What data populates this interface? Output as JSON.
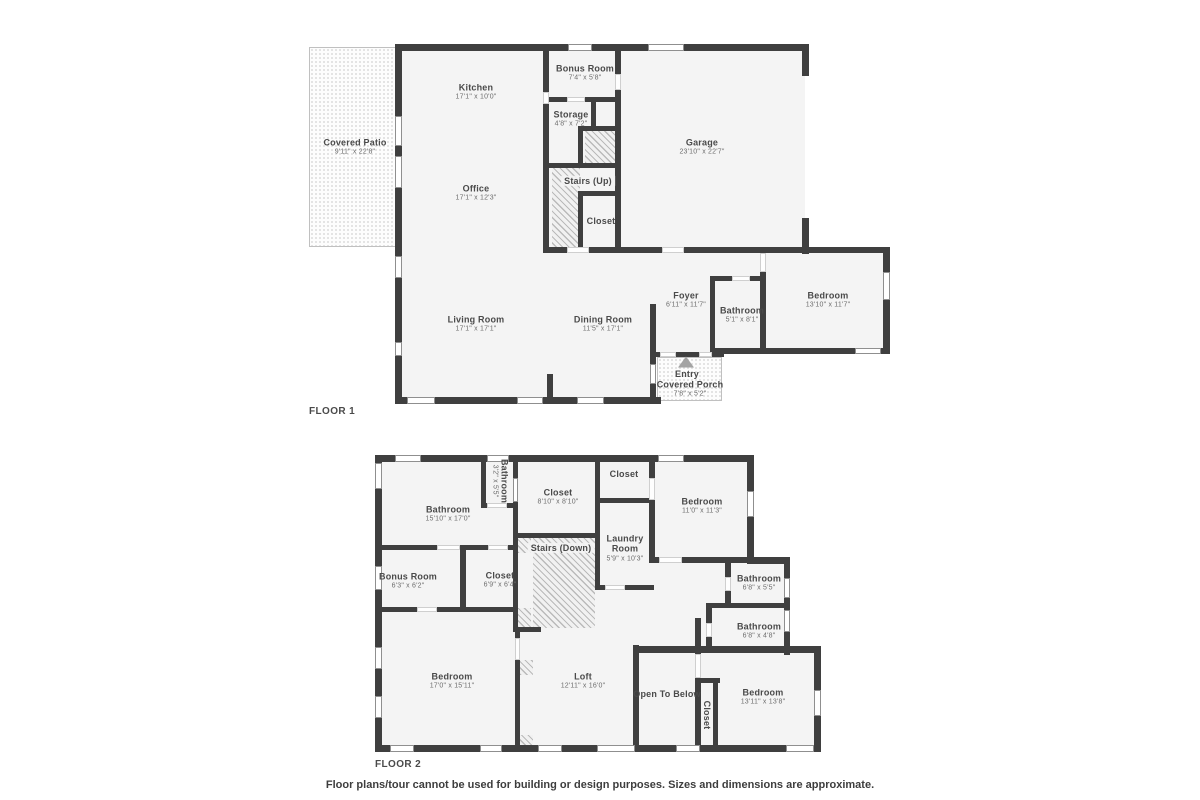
{
  "footer": "Floor plans/tour cannot be used for building or design purposes. Sizes and dimensions are approximate.",
  "colors": {
    "wall": "#3f3f3f",
    "room_fill": "#f4f4f4",
    "label_text": "#4a4a4a",
    "dims_text": "#6d6d6d",
    "outdoor_border": "#c0c0c0"
  },
  "floors": [
    {
      "label": "FLOOR 1",
      "fills": [
        [
          398,
          47,
          407,
          203
        ],
        [
          398,
          250,
          258,
          150
        ],
        [
          656,
          250,
          230,
          104
        ]
      ],
      "outdoor": [
        [
          309,
          47,
          90,
          200
        ],
        [
          657,
          357,
          65,
          44
        ]
      ],
      "hatch": [
        [
          585,
          130,
          30,
          33
        ],
        [
          552,
          168,
          28,
          82
        ]
      ],
      "walls": [
        [
          395,
          44,
          414,
          7
        ],
        [
          395,
          44,
          7,
          360
        ],
        [
          395,
          397,
          266,
          7
        ],
        [
          802,
          44,
          7,
          32
        ],
        [
          802,
          218,
          7,
          36
        ],
        [
          543,
          247,
          24,
          6
        ],
        [
          589,
          247,
          73,
          6
        ],
        [
          684,
          247,
          205,
          6
        ],
        [
          543,
          44,
          6,
          48
        ],
        [
          543,
          104,
          6,
          149
        ],
        [
          615,
          44,
          6,
          30
        ],
        [
          615,
          90,
          6,
          163
        ],
        [
          543,
          97,
          24,
          5
        ],
        [
          585,
          97,
          36,
          5
        ],
        [
          591,
          102,
          5,
          28
        ],
        [
          578,
          126,
          43,
          5
        ],
        [
          578,
          126,
          5,
          42
        ],
        [
          543,
          163,
          78,
          5
        ],
        [
          578,
          191,
          43,
          5
        ],
        [
          578,
          191,
          5,
          62
        ],
        [
          547,
          374,
          6,
          30
        ],
        [
          650,
          304,
          6,
          100
        ],
        [
          650,
          352,
          10,
          5
        ],
        [
          676,
          352,
          23,
          5
        ],
        [
          712,
          352,
          12,
          5
        ],
        [
          710,
          276,
          5,
          78
        ],
        [
          710,
          276,
          22,
          5
        ],
        [
          750,
          276,
          15,
          5
        ],
        [
          760,
          272,
          6,
          82
        ],
        [
          710,
          348,
          180,
          6
        ],
        [
          883,
          247,
          7,
          107
        ]
      ],
      "windows": [
        [
          568,
          44,
          24,
          7
        ],
        [
          648,
          44,
          36,
          7
        ],
        [
          395,
          116,
          7,
          30
        ],
        [
          395,
          156,
          7,
          32
        ],
        [
          395,
          256,
          7,
          22
        ],
        [
          395,
          342,
          7,
          14
        ],
        [
          407,
          397,
          28,
          7
        ],
        [
          517,
          397,
          26,
          7
        ],
        [
          577,
          397,
          27,
          7
        ],
        [
          650,
          364,
          6,
          20
        ],
        [
          883,
          272,
          7,
          28
        ],
        [
          855,
          348,
          26,
          6
        ]
      ],
      "doors": [
        [
          567,
          247,
          22,
          6
        ],
        [
          662,
          247,
          22,
          6
        ],
        [
          567,
          97,
          18,
          5
        ],
        [
          543,
          92,
          6,
          12
        ],
        [
          615,
          74,
          6,
          16
        ],
        [
          732,
          276,
          18,
          5
        ],
        [
          760,
          253,
          6,
          19
        ],
        [
          660,
          352,
          16,
          5
        ],
        [
          699,
          352,
          13,
          5
        ]
      ],
      "rooms": [
        {
          "name": "Covered Patio",
          "dims": "9'11\" x 22'8\"",
          "pos": [
            355,
            147
          ]
        },
        {
          "name": "Kitchen",
          "dims": "17'1\" x 10'0\"",
          "pos": [
            476,
            92
          ]
        },
        {
          "name": "Bonus Room",
          "dims": "7'4\" x 5'8\"",
          "pos": [
            585,
            73
          ]
        },
        {
          "name": "Storage",
          "dims": "4'8\" x 7'2\"",
          "pos": [
            571,
            119
          ]
        },
        {
          "name": "Office",
          "dims": "17'1\" x 12'3\"",
          "pos": [
            476,
            193
          ]
        },
        {
          "name": "Stairs (Up)",
          "dims": "",
          "pos": [
            588,
            181
          ],
          "bg": true
        },
        {
          "name": "Closet",
          "dims": "",
          "pos": [
            601,
            221
          ]
        },
        {
          "name": "Garage",
          "dims": "23'10\" x 22'7\"",
          "pos": [
            702,
            147
          ]
        },
        {
          "name": "Living Room",
          "dims": "17'1\" x 17'1\"",
          "pos": [
            476,
            324
          ]
        },
        {
          "name": "Dining Room",
          "dims": "11'5\" x 17'1\"",
          "pos": [
            603,
            324
          ]
        },
        {
          "name": "Foyer",
          "dims": "6'11\" x 11'7\"",
          "pos": [
            686,
            300
          ]
        },
        {
          "name": "Bathroom",
          "dims": "5'1\" x 8'1\"",
          "pos": [
            742,
            315
          ]
        },
        {
          "name": "Bedroom",
          "dims": "13'10\" x 11'7\"",
          "pos": [
            828,
            300
          ]
        },
        {
          "name": "Entry",
          "dims": "",
          "pos": [
            687,
            374
          ]
        },
        {
          "name": "Covered Porch",
          "dims": "7'8\" x 5'2\"",
          "pos": [
            690,
            389
          ]
        }
      ],
      "entry_icon": [
        686,
        362
      ]
    },
    {
      "label": "FLOOR 2",
      "fills": [
        [
          379,
          459,
          372,
          290
        ],
        [
          751,
          560,
          36,
          188
        ],
        [
          787,
          652,
          31,
          96
        ]
      ],
      "outdoor": [],
      "hatch": [
        [
          518,
          538,
          13,
          15
        ],
        [
          533,
          538,
          62,
          90
        ],
        [
          518,
          608,
          13,
          20
        ],
        [
          520,
          660,
          13,
          15
        ],
        [
          520,
          735,
          13,
          12
        ]
      ],
      "walls": [
        [
          375,
          455,
          379,
          7
        ],
        [
          375,
          455,
          7,
          297
        ],
        [
          375,
          745,
          446,
          7
        ],
        [
          747,
          455,
          7,
          109
        ],
        [
          747,
          557,
          43,
          7
        ],
        [
          784,
          557,
          6,
          98
        ],
        [
          784,
          646,
          37,
          7
        ],
        [
          814,
          649,
          7,
          103
        ],
        [
          481,
          455,
          5,
          53
        ],
        [
          513,
          455,
          5,
          83
        ],
        [
          595,
          455,
          5,
          135
        ],
        [
          649,
          455,
          6,
          23
        ],
        [
          649,
          500,
          6,
          63
        ],
        [
          460,
          545,
          6,
          67
        ],
        [
          513,
          533,
          5,
          99
        ],
        [
          515,
          628,
          5,
          10
        ],
        [
          515,
          660,
          5,
          90
        ],
        [
          633,
          645,
          6,
          105
        ],
        [
          695,
          618,
          6,
          36
        ],
        [
          695,
          678,
          6,
          72
        ],
        [
          713,
          678,
          5,
          72
        ],
        [
          695,
          678,
          25,
          5
        ],
        [
          725,
          563,
          6,
          14
        ],
        [
          725,
          591,
          6,
          16
        ],
        [
          706,
          607,
          6,
          16
        ],
        [
          706,
          637,
          6,
          14
        ],
        [
          481,
          503,
          37,
          5
        ],
        [
          513,
          533,
          87,
          5
        ],
        [
          595,
          498,
          59,
          5
        ],
        [
          649,
          557,
          10,
          6
        ],
        [
          682,
          557,
          108,
          6
        ],
        [
          375,
          545,
          62,
          5
        ],
        [
          466,
          545,
          24,
          5
        ],
        [
          508,
          545,
          10,
          5
        ],
        [
          375,
          607,
          42,
          5
        ],
        [
          437,
          607,
          81,
          5
        ],
        [
          595,
          585,
          10,
          5
        ],
        [
          625,
          585,
          29,
          5
        ],
        [
          513,
          627,
          28,
          5
        ],
        [
          633,
          646,
          188,
          7
        ],
        [
          706,
          603,
          84,
          5
        ]
      ],
      "windows": [
        [
          395,
          455,
          26,
          7
        ],
        [
          487,
          455,
          22,
          7
        ],
        [
          658,
          455,
          26,
          7
        ],
        [
          375,
          463,
          7,
          26
        ],
        [
          375,
          566,
          7,
          24
        ],
        [
          375,
          647,
          7,
          22
        ],
        [
          375,
          696,
          7,
          22
        ],
        [
          390,
          745,
          24,
          7
        ],
        [
          480,
          745,
          22,
          7
        ],
        [
          538,
          745,
          24,
          7
        ],
        [
          597,
          745,
          38,
          7
        ],
        [
          676,
          745,
          24,
          7
        ],
        [
          786,
          745,
          28,
          7
        ],
        [
          747,
          491,
          7,
          26
        ],
        [
          784,
          578,
          6,
          20
        ],
        [
          784,
          610,
          6,
          22
        ],
        [
          814,
          690,
          7,
          26
        ],
        [
          513,
          478,
          5,
          24
        ]
      ],
      "doors": [
        [
          487,
          503,
          20,
          5
        ],
        [
          437,
          545,
          23,
          5
        ],
        [
          488,
          545,
          20,
          5
        ],
        [
          417,
          607,
          20,
          5
        ],
        [
          515,
          638,
          5,
          22
        ],
        [
          649,
          478,
          6,
          22
        ],
        [
          659,
          557,
          23,
          6
        ],
        [
          695,
          654,
          6,
          24
        ],
        [
          725,
          577,
          6,
          14
        ],
        [
          706,
          623,
          6,
          14
        ],
        [
          605,
          585,
          20,
          5
        ]
      ],
      "rooms": [
        {
          "name": "Bathroom",
          "dims": "15'10\" x 17'0\"",
          "pos": [
            448,
            514
          ]
        },
        {
          "name": "Bathroom",
          "dims": "3'2\" x 5'5\"",
          "pos": [
            500,
            481
          ],
          "rot": true
        },
        {
          "name": "Closet",
          "dims": "8'10\" x 8'10\"",
          "pos": [
            558,
            497
          ]
        },
        {
          "name": "Closet",
          "dims": "",
          "pos": [
            624,
            474
          ]
        },
        {
          "name": "Bedroom",
          "dims": "11'0\" x 11'3\"",
          "pos": [
            702,
            506
          ]
        },
        {
          "name": "Laundry\nRoom",
          "dims": "5'9\" x 10'3\"",
          "pos": [
            625,
            548
          ]
        },
        {
          "name": "Stairs (Down)",
          "dims": "",
          "pos": [
            561,
            548
          ],
          "bg": true
        },
        {
          "name": "Bonus Room",
          "dims": "6'3\" x 6'2\"",
          "pos": [
            408,
            581
          ]
        },
        {
          "name": "Closet",
          "dims": "6'9\" x 6'4\"",
          "pos": [
            500,
            580
          ]
        },
        {
          "name": "Bathroom",
          "dims": "6'8\" x 5'5\"",
          "pos": [
            759,
            583
          ]
        },
        {
          "name": "Bathroom",
          "dims": "6'8\" x 4'8\"",
          "pos": [
            759,
            631
          ]
        },
        {
          "name": "Bedroom",
          "dims": "17'0\" x 15'11\"",
          "pos": [
            452,
            681
          ]
        },
        {
          "name": "Loft",
          "dims": "12'11\" x 16'0\"",
          "pos": [
            583,
            681
          ]
        },
        {
          "name": "Open To Below",
          "dims": "",
          "pos": [
            667,
            694
          ]
        },
        {
          "name": "Closet",
          "dims": "",
          "pos": [
            707,
            715
          ],
          "rot": true
        },
        {
          "name": "Bedroom",
          "dims": "13'11\" x 13'8\"",
          "pos": [
            763,
            697
          ]
        }
      ],
      "entry_icon": null
    }
  ]
}
